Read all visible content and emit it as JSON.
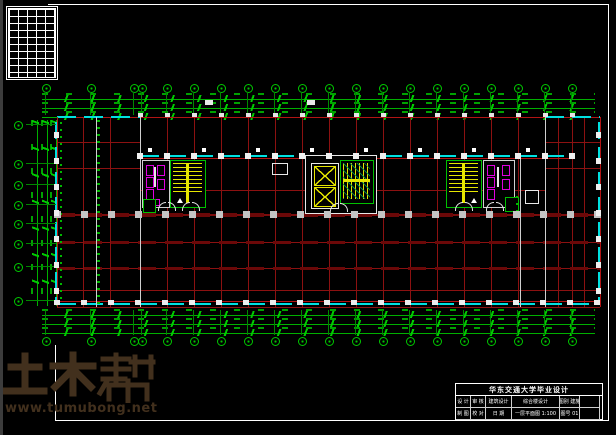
{
  "watermark": {
    "brand": "土木帮",
    "url": "www.tumubong.net",
    "color": "#42301d"
  },
  "title_block": {
    "header": "华东交通大学毕业设计",
    "cells": {
      "c1": "设 计",
      "c2": "制 图",
      "c3": "审 核",
      "c4": "校 对",
      "c5": "建筑设计",
      "c6": "日 期",
      "c7": "综合楼设计",
      "c8": "一层平面图 1:100",
      "c9": "图别 建施",
      "c10": "图号 01"
    }
  },
  "drawing": {
    "colors": {
      "grid_red": "#8c1111",
      "beam_red": "#6b0808",
      "window_cyan": "#00e0e0",
      "dimension_green": "#00b800",
      "stair_yellow": "#e6e600",
      "fixture_magenta": "#e000e0",
      "sheet_frame_white": "#ffffff",
      "watermark_brown": "#42301d"
    },
    "axes": {
      "top": [
        45,
        90,
        133,
        141,
        166,
        193,
        220,
        247,
        274,
        301,
        328,
        355,
        382,
        409,
        436,
        463,
        490,
        517,
        544,
        571
      ],
      "bottom": [
        45,
        90,
        133,
        141,
        166,
        193,
        220,
        247,
        274,
        301,
        328,
        355,
        382,
        409,
        436,
        463,
        490,
        517,
        544,
        571
      ],
      "left": [
        124,
        163,
        184,
        204,
        223,
        243,
        266,
        300
      ]
    },
    "columns": [
      {
        "o": "h",
        "y": 113,
        "x0": 140,
        "x1": 572,
        "step": 27,
        "w": 5,
        "h": 4,
        "c": "#e6e6e6"
      },
      {
        "o": "h",
        "y": 153,
        "x0": 140,
        "x1": 572,
        "step": 27,
        "w": 6,
        "h": 6,
        "c": "#f0f0f0"
      },
      {
        "o": "h",
        "y": 148,
        "x0": 150,
        "x1": 560,
        "step": 54,
        "w": 4,
        "h": 4,
        "c": "#ffffff"
      },
      {
        "o": "h",
        "y": 211,
        "x0": 57,
        "x1": 601,
        "step": 27,
        "w": 7,
        "h": 7,
        "c": "#c4c4c4"
      },
      {
        "o": "h",
        "y": 300,
        "x0": 57,
        "x1": 601,
        "step": 27,
        "w": 6,
        "h": 5,
        "c": "#ededed"
      },
      {
        "o": "v",
        "x": 54,
        "y0": 135,
        "y1": 300,
        "step": 26,
        "w": 5,
        "h": 6,
        "c": "#efefef"
      },
      {
        "o": "v",
        "x": 596,
        "y0": 135,
        "y1": 300,
        "step": 26,
        "w": 5,
        "h": 6,
        "c": "#efefef"
      }
    ]
  }
}
